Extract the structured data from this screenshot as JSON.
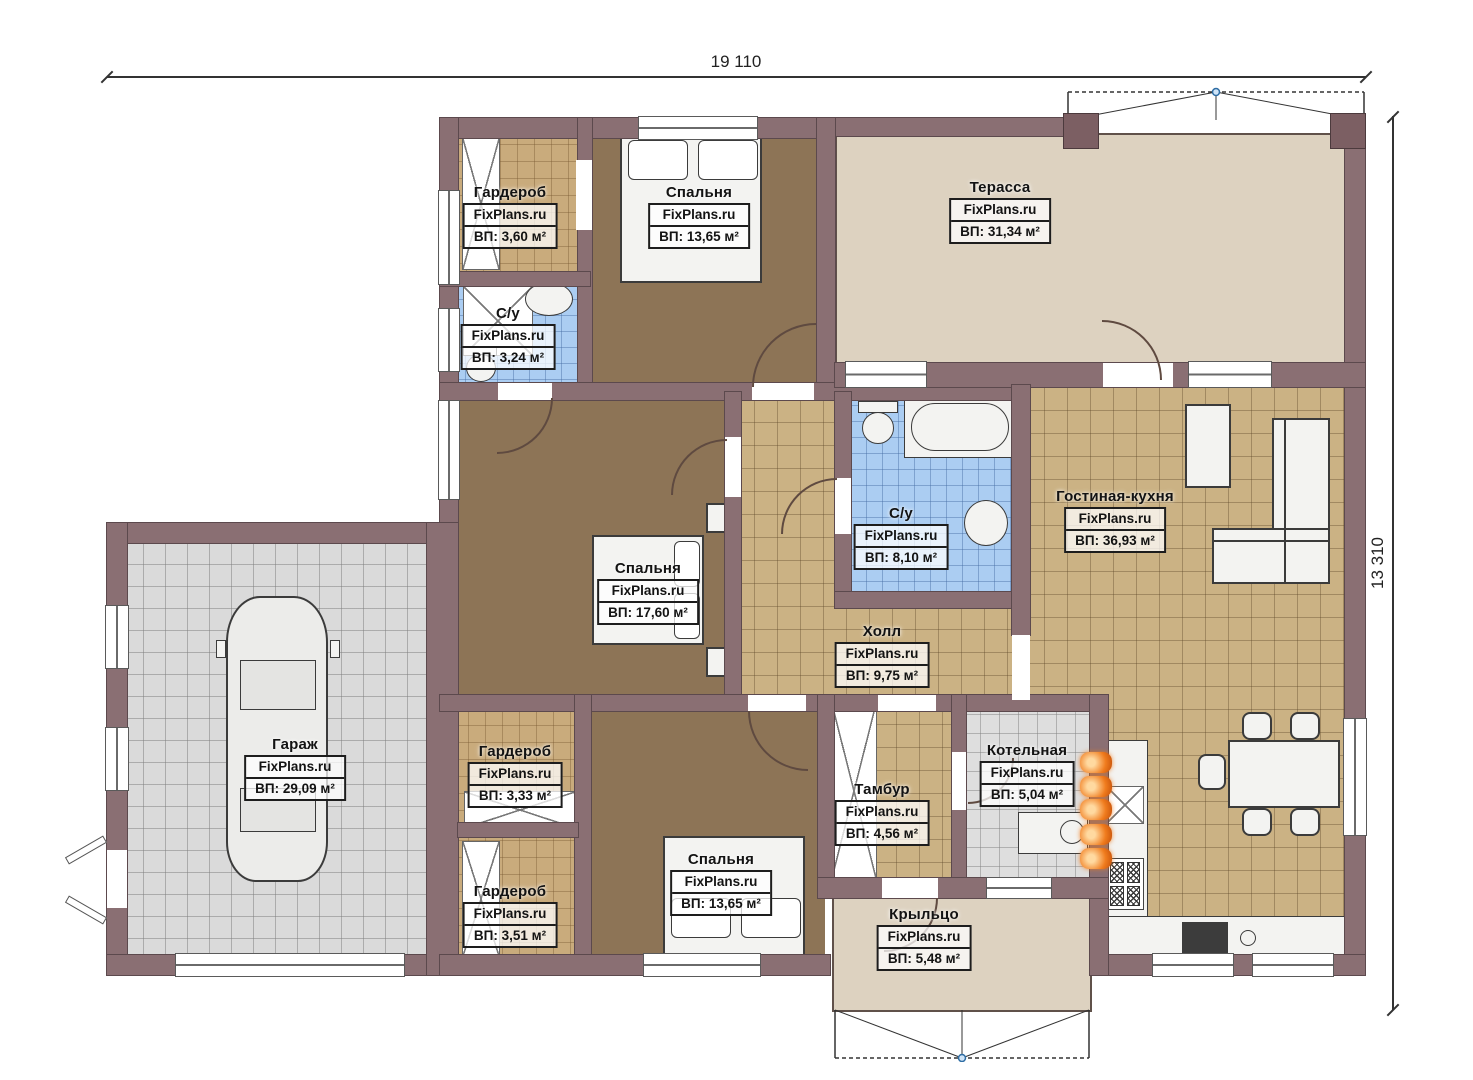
{
  "watermark": "FixPlans.ru",
  "dimensions": {
    "width": "19 110",
    "height": "13 310"
  },
  "rooms": {
    "wardrobe_tl": {
      "name": "Гардероб",
      "area": "ВП: 3,60 м²"
    },
    "bedroom_top": {
      "name": "Спальня",
      "area": "ВП: 13,65 м²"
    },
    "terrace": {
      "name": "Терасса",
      "area": "ВП: 31,34 м²"
    },
    "bath_small": {
      "name": "С/у",
      "area": "ВП: 3,24 м²"
    },
    "bedroom_mid": {
      "name": "Спальня",
      "area": "ВП: 17,60 м²"
    },
    "bath_main": {
      "name": "С/у",
      "area": "ВП: 8,10 м²"
    },
    "living_kitchen": {
      "name": "Гостиная-кухня",
      "area": "ВП: 36,93 м²"
    },
    "hall": {
      "name": "Холл",
      "area": "ВП: 9,75 м²"
    },
    "garage": {
      "name": "Гараж",
      "area": "ВП: 29,09 м²"
    },
    "wardrobe_mid": {
      "name": "Гардероб",
      "area": "ВП: 3,33 м²"
    },
    "boiler": {
      "name": "Котельная",
      "area": "ВП: 5,04 м²"
    },
    "tambour": {
      "name": "Тамбур",
      "area": "ВП: 4,56 м²"
    },
    "wardrobe_bot": {
      "name": "Гардероб",
      "area": "ВП: 3,51 м²"
    },
    "bedroom_bottom": {
      "name": "Спальня",
      "area": "ВП: 13,65 м²"
    },
    "porch": {
      "name": "Крыльцо",
      "area": "ВП: 5,48 м²"
    }
  },
  "colors": {
    "wall": "#8a6f73",
    "floor_bedroom": "#8d7456",
    "floor_tile": "#cbb284",
    "floor_wood": "#c9ab7c",
    "floor_bath": "#abcdf2",
    "floor_garage": "#dadada",
    "floor_terrace": "#ddd2c0",
    "radiator_accent": "#f07c1e"
  }
}
